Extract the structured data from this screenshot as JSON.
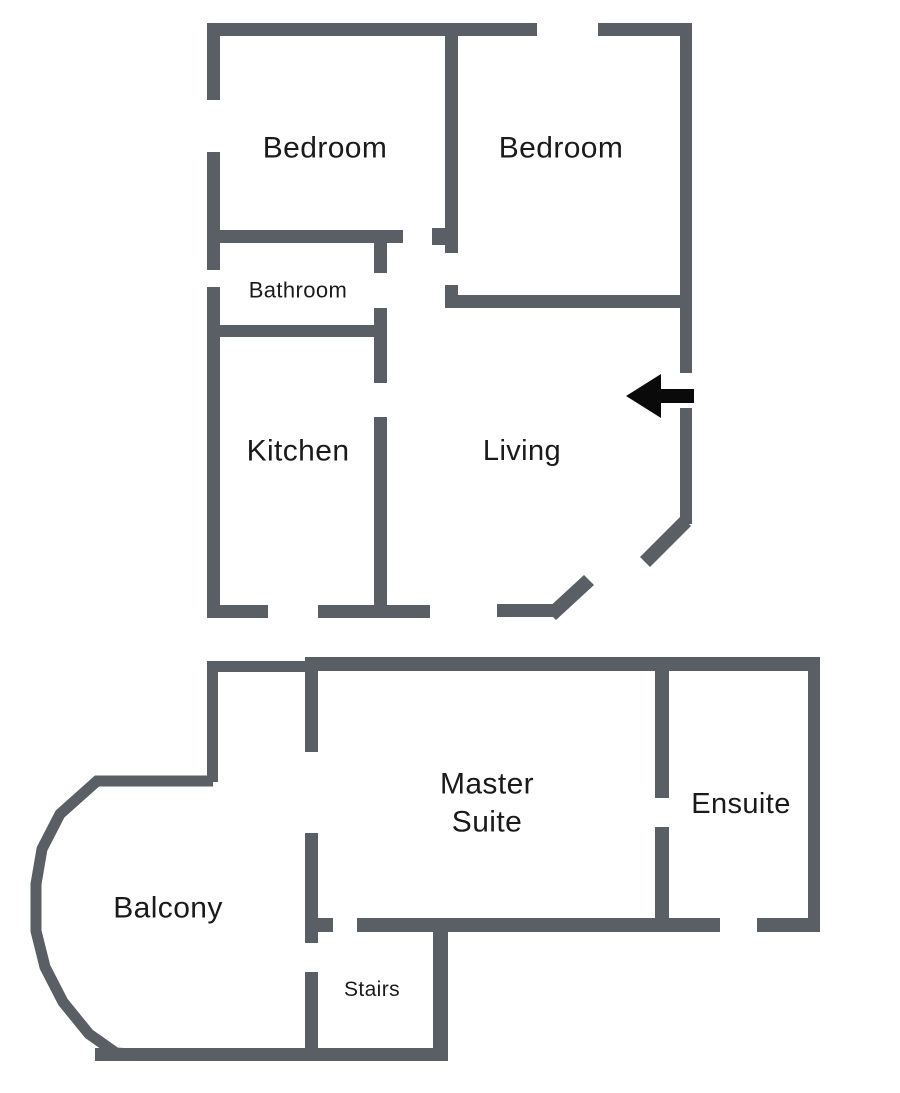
{
  "colors": {
    "wall": "#5a5e65",
    "arrow": "#0a0a0a",
    "text": "#1a1a1a",
    "background": "#ffffff"
  },
  "upper_floor": {
    "rooms": {
      "bedroom_left": {
        "label": "Bedroom"
      },
      "bedroom_right": {
        "label": "Bedroom"
      },
      "bathroom": {
        "label": "Bathroom"
      },
      "kitchen": {
        "label": "Kitchen"
      },
      "living": {
        "label": "Living"
      }
    },
    "entrance_arrow": {
      "direction": "left"
    }
  },
  "lower_floor": {
    "rooms": {
      "master_suite": {
        "label": "Master Suite"
      },
      "ensuite": {
        "label": "Ensuite"
      },
      "balcony": {
        "label": "Balcony"
      },
      "stairs": {
        "label": "Stairs"
      }
    }
  }
}
